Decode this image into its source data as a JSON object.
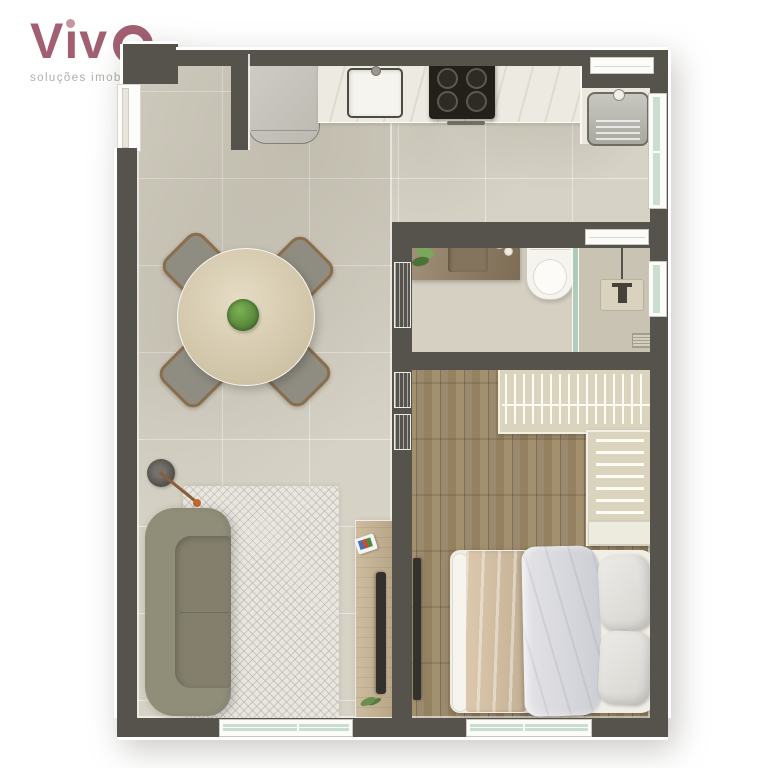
{
  "brand": {
    "name": "Viva",
    "name_prefix_glyphs": "Vıv",
    "tagline": "soluções imobiliárias",
    "color": "#a35f72",
    "tagline_color": "#b2afab"
  },
  "floor_plan": {
    "type": "apartment-top-view-render",
    "wall_color": "#56534c",
    "floor_tile_color": "#d6d2c5",
    "wood_floor_color": "#97856a",
    "window_glass_color": "#c9ddd0",
    "rooms": [
      {
        "name": "kitchen-living-dining",
        "floor": "ceramic-tile",
        "furniture": [
          "refrigerator",
          "kitchen-counter",
          "kitchen-sink",
          "cooktop-4-burners",
          "round-dining-table",
          "dining-chairs-x4",
          "table-centerpiece-plant",
          "floor-lamp",
          "area-rug",
          "sofa",
          "tv-console",
          "tv",
          "magazine",
          "console-plant"
        ]
      },
      {
        "name": "service-area",
        "furniture": [
          "laundry-tank",
          "service-counter"
        ]
      },
      {
        "name": "bathroom",
        "furniture": [
          "vanity-counter",
          "vanity-sink",
          "vanity-plant",
          "toilet",
          "shower-glass-partition",
          "shower-unit",
          "floor-drain"
        ]
      },
      {
        "name": "bedroom",
        "floor": "wood-planks",
        "furniture": [
          "wardrobe-hanging-section",
          "wardrobe-shelf-section",
          "night-shelf",
          "double-bed",
          "blanket",
          "duvet",
          "pillows-x2",
          "wall-tv"
        ]
      }
    ],
    "doors": [
      "entry-door-top-left",
      "bathroom-frosted-door",
      "bedroom-frosted-panels"
    ],
    "windows": [
      "service-top-window",
      "service-side-window",
      "bathroom-transom-window",
      "shower-side-window",
      "living-bottom-window",
      "bedroom-bottom-window"
    ]
  }
}
